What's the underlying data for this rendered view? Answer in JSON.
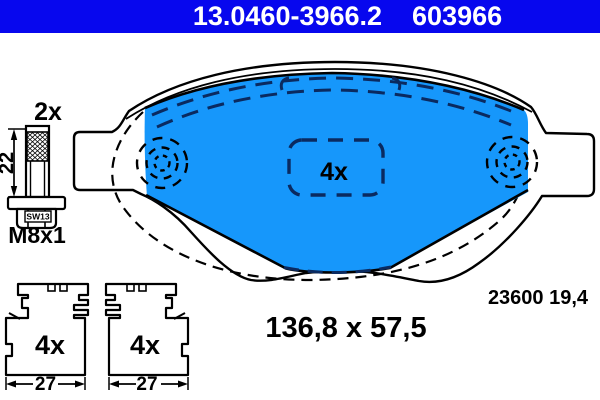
{
  "header": {
    "catalog_number": "13.0460-3966.2",
    "article_number": "603966"
  },
  "colors": {
    "header_blue": "#0707ee",
    "pad_blue": "#1697fb",
    "dash_navy": "#0a2a60",
    "line_black": "#000000"
  },
  "bolt": {
    "quantity_label": "2x",
    "length_dimension": "22",
    "wrench_size_label": "SW13",
    "thread_label": "M8x1"
  },
  "pad": {
    "quantity_label": "4x",
    "wva_number_label": "23600 19,4",
    "size_label": "136,8 x 57,5"
  },
  "clip_left": {
    "quantity_label": "4x",
    "width_dimension": "27"
  },
  "clip_right": {
    "quantity_label": "4x",
    "width_dimension": "27"
  }
}
